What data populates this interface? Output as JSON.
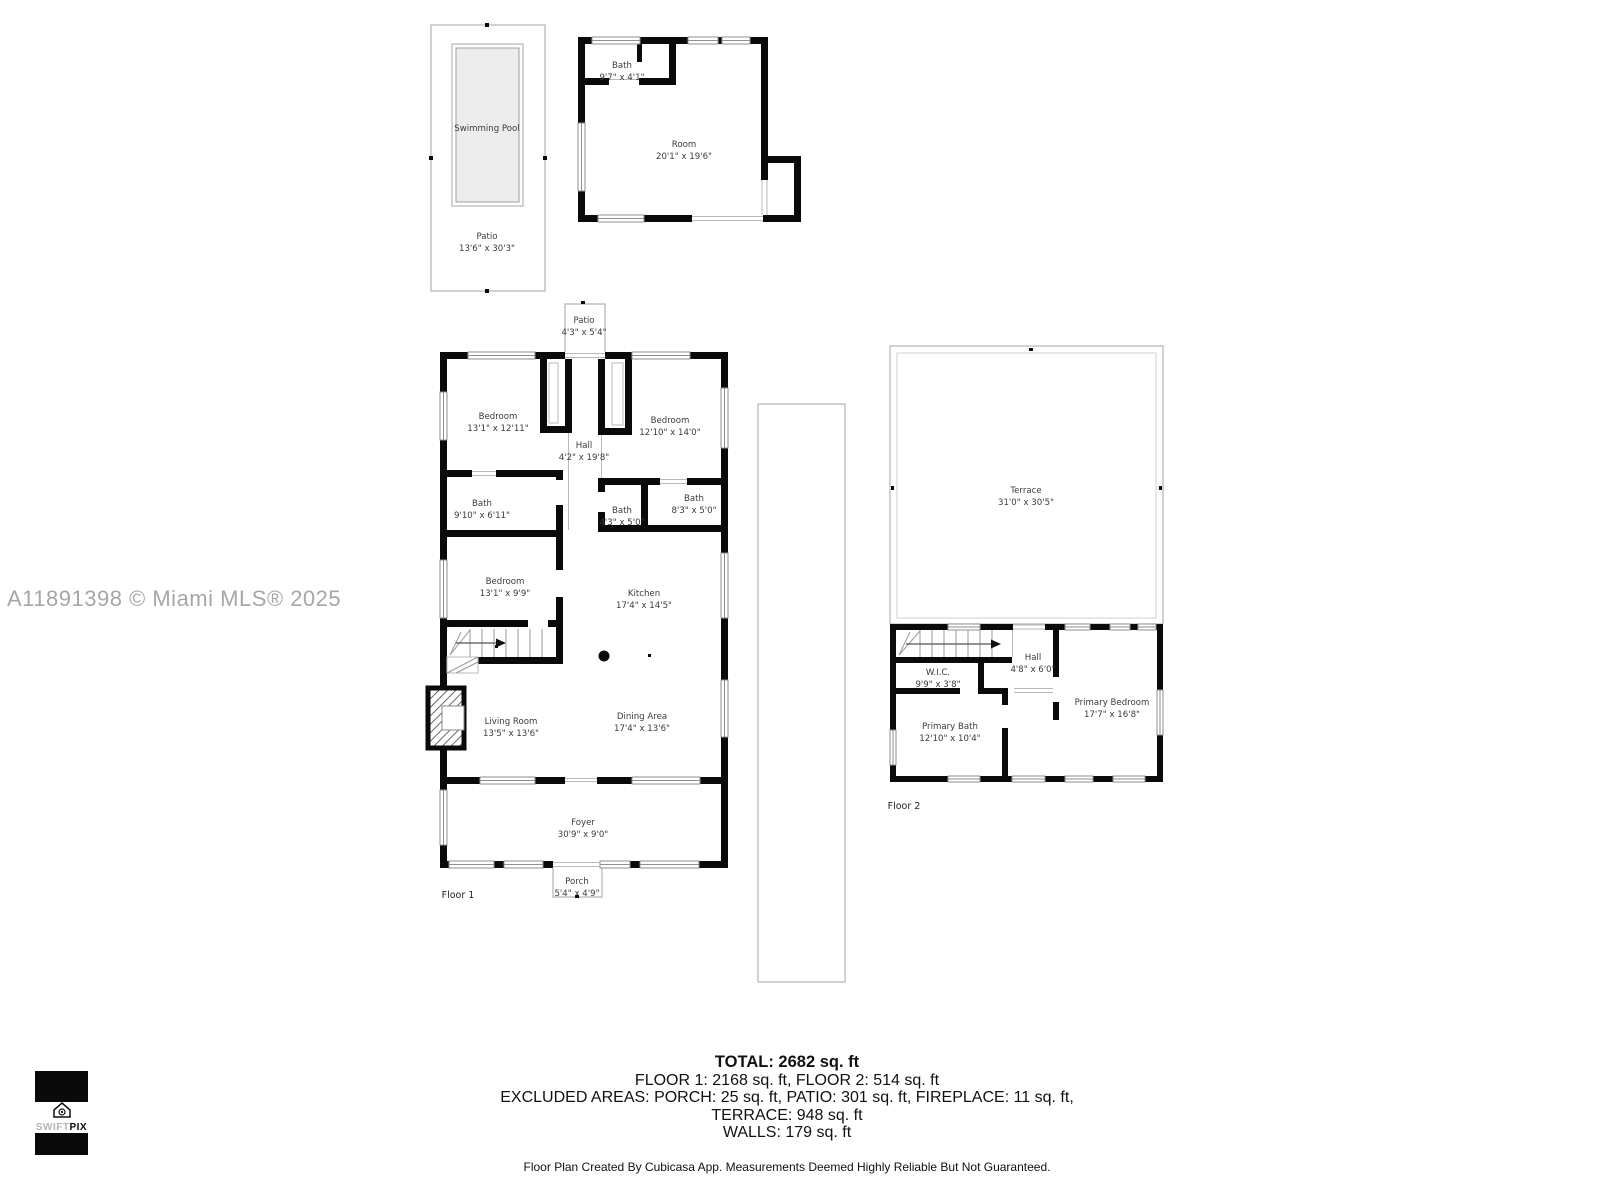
{
  "watermark": "A11891398 © Miami MLS® 2025",
  "outbuilding": {
    "pool": "Swimming Pool",
    "patio": {
      "name": "Patio",
      "dims": "13'6\" x 30'3\""
    },
    "bath": {
      "name": "Bath",
      "dims": "9'7\" x 4'1\""
    },
    "room": {
      "name": "Room",
      "dims": "20'1\" x 19'6\""
    }
  },
  "floor1": {
    "tag": "Floor 1",
    "patio": {
      "name": "Patio",
      "dims": "4'3\" x 5'4\""
    },
    "porch": {
      "name": "Porch",
      "dims": "5'4\" x 4'9\""
    },
    "bedroom_top_left": {
      "name": "Bedroom",
      "dims": "13'1\" x 12'11\""
    },
    "hall": {
      "name": "Hall",
      "dims": "4'2\" x 19'8\""
    },
    "bedroom_top_right": {
      "name": "Bedroom",
      "dims": "12'10\" x 14'0\""
    },
    "bath_left": {
      "name": "Bath",
      "dims": "9'10\" x 6'11\""
    },
    "bath_center": {
      "name": "Bath",
      "dims": "4'3\" x 5'0\""
    },
    "bath_right": {
      "name": "Bath",
      "dims": "8'3\" x 5'0\""
    },
    "bedroom_mid": {
      "name": "Bedroom",
      "dims": "13'1\" x 9'9\""
    },
    "kitchen": {
      "name": "Kitchen",
      "dims": "17'4\" x 14'5\""
    },
    "living": {
      "name": "Living Room",
      "dims": "13'5\" x 13'6\""
    },
    "dining": {
      "name": "Dining Area",
      "dims": "17'4\" x 13'6\""
    },
    "foyer": {
      "name": "Foyer",
      "dims": "30'9\" x 9'0\""
    }
  },
  "floor2": {
    "tag": "Floor 2",
    "terrace": {
      "name": "Terrace",
      "dims": "31'0\" x 30'5\""
    },
    "wic": {
      "name": "W.I.C.",
      "dims": "9'9\" x 3'8\""
    },
    "hall": {
      "name": "Hall",
      "dims": "4'8\" x 6'0\""
    },
    "primary_bedroom": {
      "name": "Primary Bedroom",
      "dims": "17'7\" x 16'8\""
    },
    "primary_bath": {
      "name": "Primary Bath",
      "dims": "12'10\" x 10'4\""
    }
  },
  "summary": {
    "total": "TOTAL: 2682 sq. ft",
    "floors": "FLOOR 1: 2168 sq. ft, FLOOR 2: 514 sq. ft",
    "excluded": "EXCLUDED AREAS: PORCH: 25 sq. ft, PATIO: 301 sq. ft, FIREPLACE: 11 sq. ft,",
    "terrace": "TERRACE: 948 sq. ft",
    "walls": "WALLS: 179 sq. ft",
    "disclaimer": "Floor Plan Created By Cubicasa App. Measurements Deemed Highly Reliable But Not Guaranteed."
  },
  "logo": {
    "swift": "SWIFT",
    "pix": "PIX"
  },
  "colors": {
    "wall": "#0a0a0a",
    "label": "#3b3b3b",
    "watermark": "#a6a6a6",
    "outline": "#b5b5b5",
    "pool_fill": "#ececec"
  }
}
